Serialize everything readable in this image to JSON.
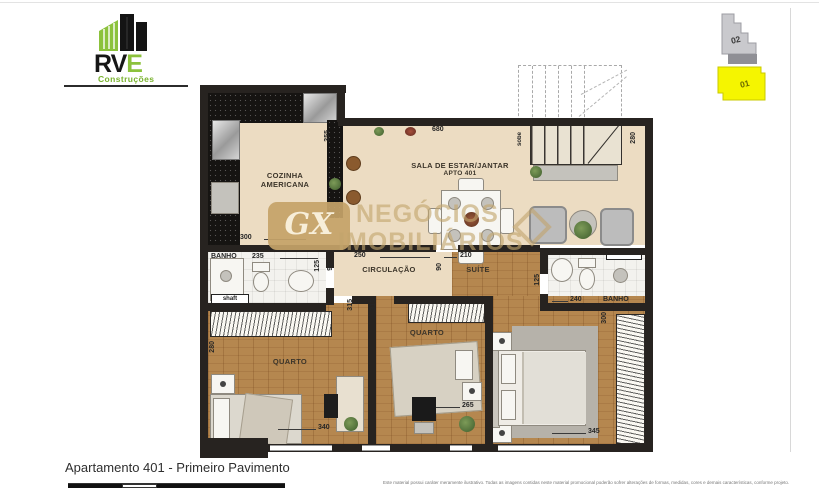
{
  "logo": {
    "rv": "RV",
    "e": "E",
    "subtitle": "Construções"
  },
  "floor_indicator": {
    "upper": "02",
    "lower": "01",
    "highlight_color": "#f5f500"
  },
  "watermark": {
    "badge": "GX",
    "line1": "NEGÓCIOS",
    "line2": "IMOBILIÁRIOS"
  },
  "rooms": {
    "kitchen_line1": "COZINHA",
    "kitchen_line2": "AMERICANA",
    "living": "SALA DE ESTAR/JANTAR",
    "living_sub": "APTO 401",
    "hall": "CIRCULAÇÃO",
    "suite": "SUÍTE",
    "bedroom1": "QUARTO",
    "bedroom2": "QUARTO",
    "bath_left": "BANHO",
    "bath_right": "BANHO",
    "stairs_note": "sobe",
    "shaft_left": "shaft",
    "shaft_right": "shaft"
  },
  "dimensions": {
    "kitchen_h": "355",
    "kitchen_w": "300",
    "living_w": "680",
    "living_h": "280",
    "bath_left_w": "235",
    "bath_left_h": "125",
    "hall_w": "250",
    "hall_h_left": "90",
    "hall_h_right": "90",
    "suite_w": "210",
    "bath_right_w": "240",
    "bath_right_h": "125",
    "suite_side": "300",
    "suite_bottom": "345",
    "bedroom1_h": "280",
    "bedroom1_w": "340",
    "bedroom2_w": "265",
    "door_left": "315",
    "door_right": "315"
  },
  "footer": {
    "title": "Apartamento 401 - Primeiro Pavimento",
    "disclaimer": "Este material possui caráter meramente ilustrativo. Todas as imagens contidas neste material promocional poderão sofrer alterações de formas, medidas, cores e demais características, conforme projeto."
  },
  "colors": {
    "wall": "#272320",
    "floor_light": "#ecdcc2",
    "floor_wood": "#b5874f",
    "logo_green": "#8cc23c",
    "highlight_yellow": "#f5f500",
    "watermark_gold": "#c5a368"
  }
}
